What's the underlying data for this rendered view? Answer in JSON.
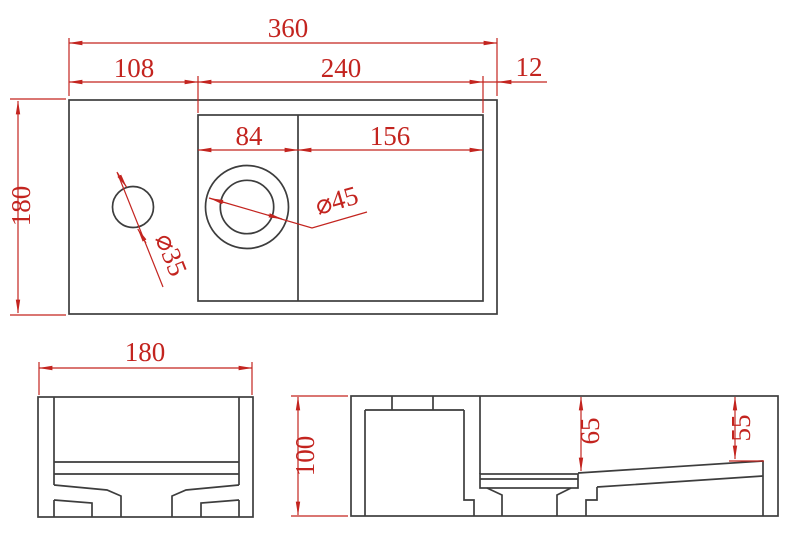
{
  "colors": {
    "background": "#ffffff",
    "geometry_line": "#3d3d3d",
    "dimension_red": "#c3241f"
  },
  "views": {
    "top": {
      "overall_width": "360",
      "segment_left": "108",
      "segment_middle": "240",
      "segment_right": "12",
      "overall_depth": "180",
      "bowl_segment_left": "84",
      "bowl_segment_right": "156",
      "faucet_hole_diameter": "⌀35",
      "drain_diameter": "⌀45"
    },
    "front": {
      "overall_width": "180"
    },
    "side": {
      "overall_height": "100",
      "bowl_depth_left": "65",
      "bowl_depth_right": "55"
    }
  }
}
